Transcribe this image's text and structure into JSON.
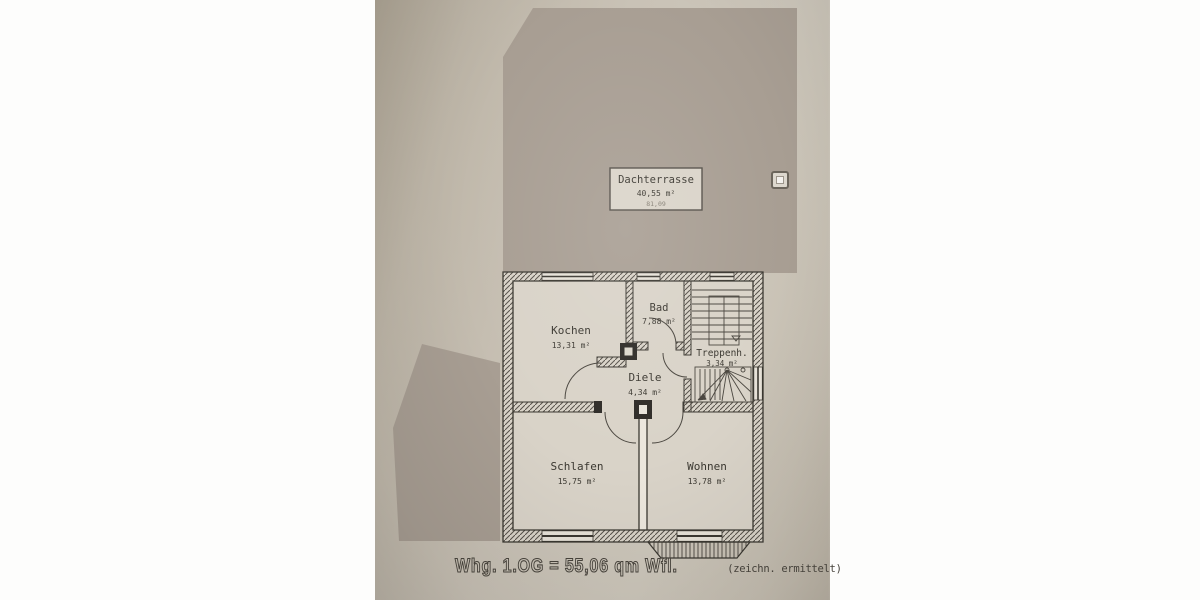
{
  "palette": {
    "photo_white": "#fdfdfc",
    "paper": "#c7c0b4",
    "terrace_fill": "#a89e93",
    "room_fill": "#d9d3c8",
    "line": "#3b3831"
  },
  "terrace": {
    "name": "Dachterrasse",
    "area": "40,55 m²",
    "gross_area": "81,09"
  },
  "rooms": {
    "kochen": {
      "name": "Kochen",
      "area": "13,31 m²"
    },
    "bad": {
      "name": "Bad",
      "area": "7,88 m²"
    },
    "treppenhaus": {
      "name": "Treppenh.",
      "area": "3,34 m²"
    },
    "diele": {
      "name": "Diele",
      "area": "4,34 m²"
    },
    "schlafen": {
      "name": "Schlafen",
      "area": "15,75 m²"
    },
    "wohnen": {
      "name": "Wohnen",
      "area": "13,78 m²"
    }
  },
  "caption": {
    "main": "Whg. 1.OG = 55,06 qm Wfl.",
    "note": "(zeichn. ermittelt)"
  }
}
